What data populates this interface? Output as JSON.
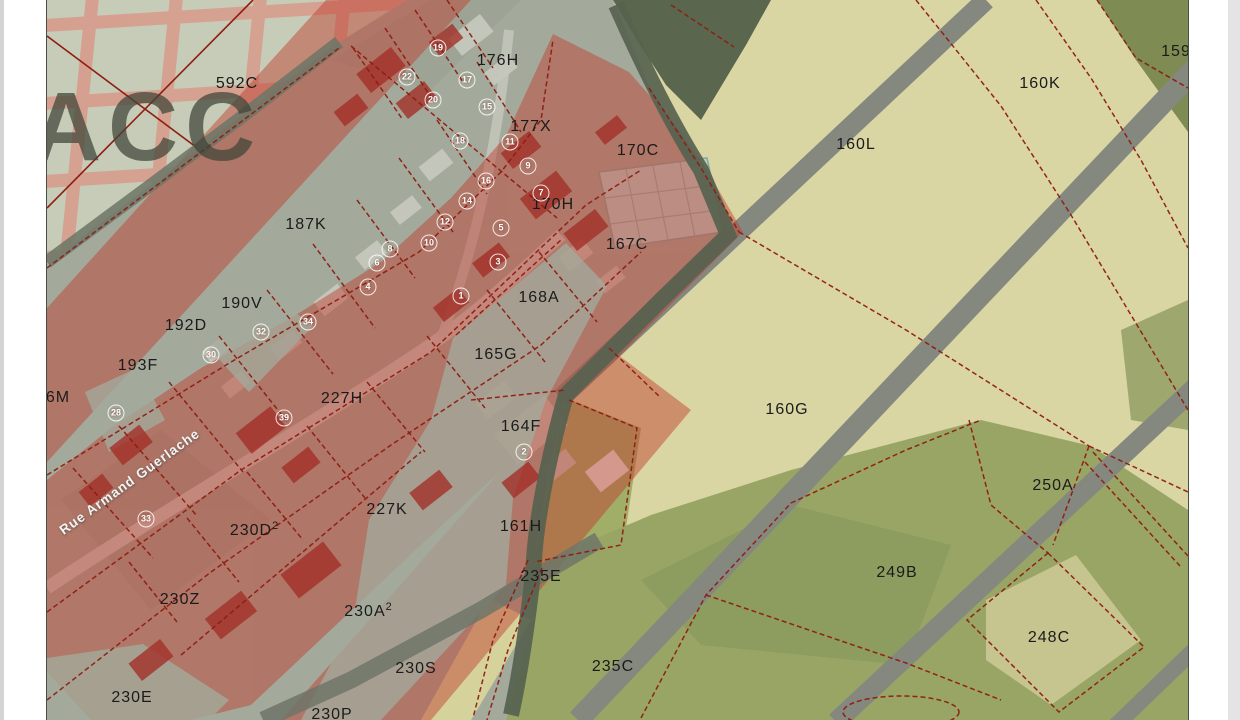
{
  "canvas": {
    "width": 1240,
    "height": 720,
    "map_left": 46,
    "map_right": 1187
  },
  "watermark": "ACC",
  "street": {
    "name": "Rue Armand Guerlache",
    "rotation_deg": -36
  },
  "colors": {
    "village_gray": "#a4aa9b",
    "field_yellow": "#d9d6a3",
    "field_olive": "#99a565",
    "field_dark_olive": "#7e8b52",
    "hedge_green": "#57624f",
    "road_gray": "#85887f",
    "street_light": "#c9ccc1",
    "red_zone": "#c0392b",
    "red_building": "#a33029",
    "grid_pink": "#d99686",
    "boundary_red": "#8f1d12",
    "building_teal": "#b9d2ca",
    "label_black": "#1b1b1b",
    "number_white": "#ffffff"
  },
  "parcels": [
    {
      "id": "592C",
      "x": 236,
      "y": 84
    },
    {
      "id": "176H",
      "x": 497,
      "y": 61
    },
    {
      "id": "177X",
      "x": 530,
      "y": 127
    },
    {
      "id": "170C",
      "x": 637,
      "y": 151
    },
    {
      "id": "170H",
      "x": 552,
      "y": 205
    },
    {
      "id": "167C",
      "x": 626,
      "y": 245
    },
    {
      "id": "187K",
      "x": 305,
      "y": 225
    },
    {
      "id": "168A",
      "x": 538,
      "y": 298
    },
    {
      "id": "190V",
      "x": 241,
      "y": 304
    },
    {
      "id": "192D",
      "x": 185,
      "y": 326
    },
    {
      "id": "193F",
      "x": 137,
      "y": 366
    },
    {
      "id": "165G",
      "x": 495,
      "y": 355
    },
    {
      "id": "6M",
      "x": 57,
      "y": 398
    },
    {
      "id": "227H",
      "x": 341,
      "y": 399
    },
    {
      "id": "164F",
      "x": 520,
      "y": 427
    },
    {
      "id": "227K",
      "x": 386,
      "y": 510
    },
    {
      "id": "161H",
      "x": 520,
      "y": 527
    },
    {
      "id": "230D",
      "sup": "2",
      "x": 253,
      "y": 530
    },
    {
      "id": "235E",
      "x": 540,
      "y": 577
    },
    {
      "id": "230Z",
      "x": 179,
      "y": 600
    },
    {
      "id": "230A",
      "sup": "2",
      "x": 367,
      "y": 611
    },
    {
      "id": "235C",
      "x": 612,
      "y": 667
    },
    {
      "id": "230S",
      "x": 415,
      "y": 669
    },
    {
      "id": "230E",
      "x": 131,
      "y": 698
    },
    {
      "id": "230P",
      "x": 331,
      "y": 715
    },
    {
      "id": "160K",
      "x": 1039,
      "y": 84
    },
    {
      "id": "160L",
      "x": 855,
      "y": 145
    },
    {
      "id": "159",
      "x": 1175,
      "y": 52
    },
    {
      "id": "160G",
      "x": 786,
      "y": 410
    },
    {
      "id": "250A",
      "x": 1052,
      "y": 486
    },
    {
      "id": "249B",
      "x": 896,
      "y": 573
    },
    {
      "id": "248C",
      "x": 1048,
      "y": 638
    }
  ],
  "house_numbers": [
    {
      "n": "19",
      "x": 437,
      "y": 48
    },
    {
      "n": "22",
      "x": 406,
      "y": 77
    },
    {
      "n": "17",
      "x": 466,
      "y": 80
    },
    {
      "n": "20",
      "x": 432,
      "y": 100
    },
    {
      "n": "15",
      "x": 486,
      "y": 107
    },
    {
      "n": "18",
      "x": 459,
      "y": 141
    },
    {
      "n": "11",
      "x": 509,
      "y": 142
    },
    {
      "n": "9",
      "x": 527,
      "y": 166
    },
    {
      "n": "16",
      "x": 485,
      "y": 181
    },
    {
      "n": "7",
      "x": 540,
      "y": 193
    },
    {
      "n": "14",
      "x": 466,
      "y": 201
    },
    {
      "n": "12",
      "x": 444,
      "y": 222
    },
    {
      "n": "5",
      "x": 500,
      "y": 228
    },
    {
      "n": "10",
      "x": 428,
      "y": 243
    },
    {
      "n": "8",
      "x": 389,
      "y": 249
    },
    {
      "n": "3",
      "x": 497,
      "y": 262
    },
    {
      "n": "6",
      "x": 376,
      "y": 263
    },
    {
      "n": "4",
      "x": 367,
      "y": 287
    },
    {
      "n": "1",
      "x": 460,
      "y": 296
    },
    {
      "n": "34",
      "x": 307,
      "y": 322
    },
    {
      "n": "32",
      "x": 260,
      "y": 332
    },
    {
      "n": "30",
      "x": 210,
      "y": 355
    },
    {
      "n": "28",
      "x": 115,
      "y": 413
    },
    {
      "n": "39",
      "x": 283,
      "y": 418
    },
    {
      "n": "2",
      "x": 523,
      "y": 452
    },
    {
      "n": "33",
      "x": 145,
      "y": 519
    }
  ]
}
